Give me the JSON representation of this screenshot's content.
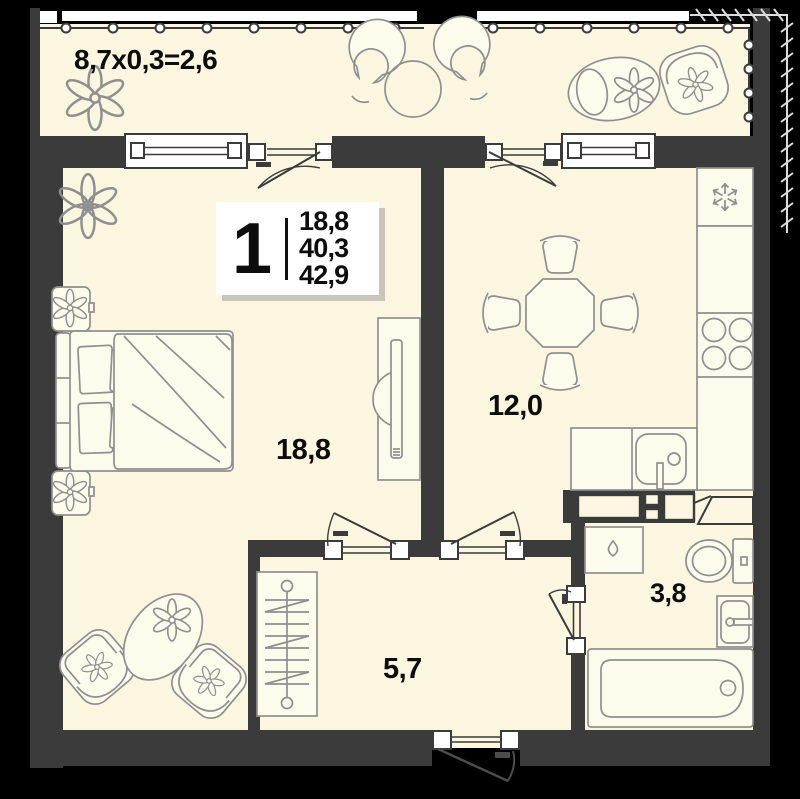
{
  "unit_card": {
    "rooms_count": "1",
    "area_living": "18,8",
    "area_main": "40,3",
    "area_total": "42,9"
  },
  "labels": {
    "balcony_formula": "8,7x0,3=2,6",
    "living_area": "18,8",
    "kitchen_area": "12,0",
    "hall_area": "5,7",
    "bath_area": "3,8"
  },
  "rooms": [
    {
      "name": "living-bedroom",
      "area": "18,8"
    },
    {
      "name": "kitchen-dining",
      "area": "12,0"
    },
    {
      "name": "hallway",
      "area": "5,7"
    },
    {
      "name": "bathroom",
      "area": "3,8"
    },
    {
      "name": "balcony",
      "dimension": "8,7x0,3=2,6"
    }
  ],
  "icons": {
    "fridge": "snowflake-icon",
    "washing_machine": "water-drop-icon",
    "plants": "flower-icon"
  },
  "colors": {
    "background": "#000000",
    "wall": "#3B3B3B",
    "floor": "#FAF6DF",
    "furniture_line": "#8F8F8F",
    "frame_white": "#FFFFFF",
    "text": "#0D0D0D",
    "card_shadow": "#C8C6BA"
  }
}
